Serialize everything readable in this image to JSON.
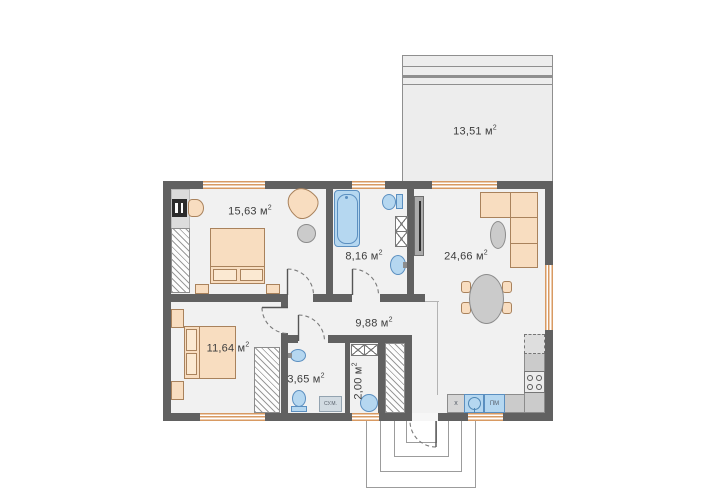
{
  "plan_labels": {
    "terrace": {
      "area": "13,51 м",
      "sup": "2"
    },
    "bedroom_top": {
      "area": "15,63 м",
      "sup": "2"
    },
    "bathroom_main": {
      "area": "8,16 м",
      "sup": "2"
    },
    "living_kitchen": {
      "area": "24,66 м",
      "sup": "2"
    },
    "hallway": {
      "area": "9,88 м",
      "sup": "2"
    },
    "bedroom_bottom": {
      "area": "11,64 м",
      "sup": "2"
    },
    "bathroom_small": {
      "area": "3,65 м",
      "sup": "2"
    },
    "vestibule": {
      "area": "2,00 м",
      "sup": "2"
    }
  },
  "appliance_labels": {
    "kitchen_unit": "x",
    "dishwasher": "ПМ",
    "washing_machine": "СУ.М."
  },
  "colors": {
    "wall": "#616161",
    "floor": "#f1f1f1",
    "furniture_wood": "#f8ddc0",
    "plumbing_blue": "#b5d7f0",
    "window_frame": "#d89a62",
    "terrace_fill": "#ededed"
  }
}
